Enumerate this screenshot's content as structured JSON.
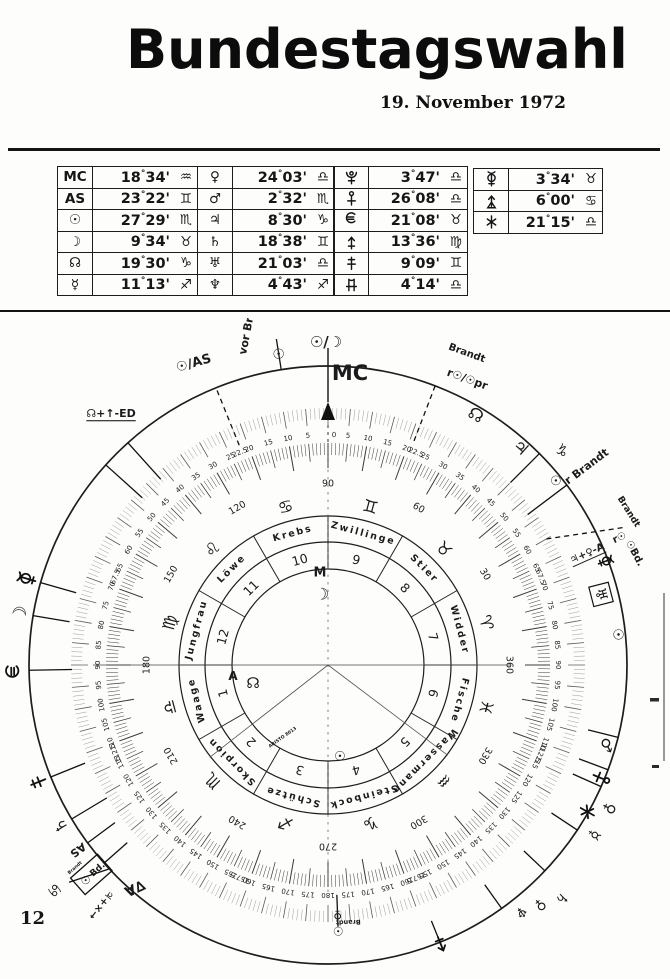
{
  "header": {
    "title": "Bundestagswahl",
    "date": "19. November 1972"
  },
  "page": {
    "number": "12"
  },
  "glyph_unicode": {
    "sun": "☉",
    "moon": "☽",
    "node": "☊",
    "mercury": "☿",
    "venus": "♀",
    "mars": "♂",
    "jupiter": "♃",
    "saturn": "♄",
    "uranus": "♅",
    "neptune": "♆",
    "aries": "♈",
    "taurus": "♉",
    "gemini": "♊",
    "cancer": "♋",
    "leo": "♌",
    "virgo": "♍",
    "libra": "♎",
    "scorpio": "♏",
    "sagittarius": "♐",
    "capricorn": "♑",
    "aquarius": "♒",
    "pisces": "♓"
  },
  "table_groups": [
    6,
    6,
    6,
    3
  ],
  "chart_data": {
    "type": "astrological-dial",
    "title": "Bundestagswahl 19. November 1972",
    "positions": [
      {
        "body": "MC",
        "label": "MC",
        "deg": "18",
        "min": "34",
        "sign": "aquarius"
      },
      {
        "body": "AS",
        "label": "AS",
        "deg": "23",
        "min": "22",
        "sign": "gemini"
      },
      {
        "body": "sun",
        "deg": "27",
        "min": "29",
        "sign": "scorpio"
      },
      {
        "body": "moon",
        "deg": "9",
        "min": "34",
        "sign": "taurus"
      },
      {
        "body": "node",
        "deg": "19",
        "min": "30",
        "sign": "capricorn"
      },
      {
        "body": "mercury",
        "deg": "11",
        "min": "13",
        "sign": "sagittarius"
      },
      {
        "body": "venus",
        "deg": "24",
        "min": "03",
        "sign": "libra"
      },
      {
        "body": "mars",
        "deg": "2",
        "min": "32",
        "sign": "scorpio"
      },
      {
        "body": "jupiter",
        "deg": "8",
        "min": "30",
        "sign": "capricorn"
      },
      {
        "body": "saturn",
        "deg": "18",
        "min": "38",
        "sign": "gemini"
      },
      {
        "body": "uranus",
        "deg": "21",
        "min": "03",
        "sign": "libra"
      },
      {
        "body": "neptune",
        "deg": "4",
        "min": "43",
        "sign": "sagittarius"
      },
      {
        "body": "pluto",
        "deg": "3",
        "min": "47",
        "sign": "libra"
      },
      {
        "body": "cupido",
        "deg": "26",
        "min": "08",
        "sign": "libra"
      },
      {
        "body": "hades",
        "deg": "21",
        "min": "08",
        "sign": "taurus"
      },
      {
        "body": "zeus",
        "deg": "13",
        "min": "36",
        "sign": "virgo"
      },
      {
        "body": "kronos",
        "deg": "9",
        "min": "09",
        "sign": "gemini"
      },
      {
        "body": "apollon",
        "deg": "4",
        "min": "14",
        "sign": "libra"
      },
      {
        "body": "admetos",
        "deg": "3",
        "min": "34",
        "sign": "taurus"
      },
      {
        "body": "vulkanus",
        "deg": "6",
        "min": "00",
        "sign": "cancer"
      },
      {
        "body": "poseidon",
        "deg": "21",
        "min": "15",
        "sign": "libra"
      }
    ],
    "dial": {
      "pointer_label": "MC",
      "top_midpoint": "☉/☽",
      "outer_scale": {
        "label_step": 5,
        "max": 180,
        "specials": [
          22.5,
          67.5,
          112.5,
          157.5
        ]
      },
      "inner_scale": {
        "label_step": 30,
        "max": 360
      },
      "houses": [
        {
          "num": "7",
          "name": "Widder",
          "sign": "aries"
        },
        {
          "num": "8",
          "name": "Stier",
          "sign": "taurus"
        },
        {
          "num": "9",
          "name": "Zwillinge",
          "sign": "gemini"
        },
        {
          "num": "10",
          "name": "Krebs",
          "sign": "cancer"
        },
        {
          "num": "11",
          "name": "Löwe",
          "sign": "leo"
        },
        {
          "num": "12",
          "name": "Jungfrau",
          "sign": "virgo"
        },
        {
          "num": "1",
          "name": "Waage",
          "sign": "libra"
        },
        {
          "num": "2",
          "name": "Skorpion",
          "sign": "scorpio"
        },
        {
          "num": "3",
          "name": "Schütze",
          "sign": "sagittarius"
        },
        {
          "num": "4",
          "name": "Steinbock",
          "sign": "capricorn"
        },
        {
          "num": "5",
          "name": "Wassermann",
          "sign": "aquarius"
        },
        {
          "num": "6",
          "name": "Fische",
          "sign": "pisces"
        }
      ],
      "center_marks": [
        {
          "text": "M",
          "x": -8,
          "y": -92,
          "f": 13
        },
        {
          "glyph": "moon",
          "x": -6,
          "y": -71,
          "f": 16
        },
        {
          "text": "A",
          "x": -95,
          "y": 11,
          "f": 12
        },
        {
          "glyph": "node",
          "x": -75,
          "y": 18,
          "f": 15
        },
        {
          "glyph": "sun",
          "x": 12,
          "y": 92,
          "f": 13
        },
        {
          "text": "ARISTO 8013",
          "x": -45,
          "y": 73,
          "f": 4.5,
          "rot": -35
        }
      ],
      "rim_items": [
        {
          "a": -9,
          "glyph": "sun",
          "r": 314,
          "f": 14,
          "line": [
            299,
            330
          ]
        },
        {
          "a": -13,
          "text": "vor Brandt",
          "r": 352,
          "rot": -79,
          "f": 11,
          "bold": true
        },
        {
          "a": -22,
          "dashed": true,
          "line": [
            237,
            299
          ]
        },
        {
          "a": -24,
          "text": "☉/AS",
          "r": 330,
          "rot": -16,
          "f": 13,
          "bold": true
        },
        {
          "a": -42,
          "line": [
            250,
            299
          ]
        },
        {
          "a": -48,
          "line": [
            250,
            299
          ]
        },
        {
          "a": -40.8,
          "text": "☊+↑-ED",
          "r": 332,
          "rot": 0,
          "f": 11,
          "u": true,
          "bold": true
        },
        {
          "a": -74,
          "glyph": "admetos",
          "r": 313,
          "line": [
            299,
            262
          ]
        },
        {
          "a": -80.5,
          "glyph": "moon",
          "r": 312,
          "f": 18,
          "line": [
            299,
            262
          ]
        },
        {
          "a": -91,
          "glyph": "hades",
          "r": 313,
          "line": [
            299,
            256
          ]
        },
        {
          "a": -112,
          "glyph": "kronos",
          "r": 313,
          "line": [
            299,
            262
          ]
        },
        {
          "a": -121,
          "glyph": "saturn",
          "r": 312,
          "f": 16,
          "line": [
            299,
            258
          ]
        },
        {
          "a": -126.5,
          "text": "AS",
          "r": 311,
          "rot": 143,
          "f": 11,
          "bold": true,
          "line": [
            299,
            265
          ]
        },
        {
          "a": -131.5,
          "boxgroup": true,
          "r": 316,
          "box_text": "Bd.",
          "box_glyph": "sun",
          "box_small": "Brandt",
          "line": [
            299,
            268
          ]
        },
        {
          "a": -129.5,
          "glyph": "cancer",
          "r": 354,
          "f": 15,
          "line2": [
            -133,
            299,
            -130,
            338
          ]
        },
        {
          "a": -136.5,
          "text": "♃+×→",
          "r": 330,
          "rot": 128,
          "f": 10,
          "bold": true
        },
        {
          "a": -139,
          "text": "∇A",
          "r": 295,
          "rot": 155,
          "f": 14,
          "bold": true
        },
        {
          "a": 24,
          "text": "Brandt",
          "r": 341,
          "rot": 20,
          "f": 10,
          "bold": true
        },
        {
          "a": 26,
          "text": "r☉/☉pr",
          "r": 318,
          "rot": 20,
          "f": 11,
          "bold": true
        },
        {
          "a": 21,
          "dashed": true,
          "line": [
            240,
            299
          ]
        },
        {
          "a": 30.6,
          "glyph": "node",
          "r": 290,
          "f": 17
        },
        {
          "a": 41.6,
          "glyph": "jupiter",
          "r": 290,
          "f": 17
        },
        {
          "a": 45,
          "line": [
            258,
            299
          ]
        },
        {
          "a": 47.5,
          "glyph": "capricorn",
          "r": 317,
          "f": 15
        },
        {
          "a": 51,
          "glyph": "sun",
          "r": 292,
          "f": 13
        },
        {
          "a": 52.5,
          "text": "r Brandt",
          "r": 326,
          "rot": -37,
          "f": 11,
          "bold": true
        },
        {
          "a": 53,
          "line": [
            250,
            299
          ]
        },
        {
          "a": 65,
          "dashed": true,
          "line2": [
            65,
            325,
            60,
            252
          ]
        },
        {
          "a": 63,
          "text": "Brandt",
          "r": 337,
          "rot": 58,
          "f": 9,
          "bold": true
        },
        {
          "a": 66.5,
          "text": "r☉",
          "r": 318,
          "rot": -24,
          "f": 10,
          "bold": true
        },
        {
          "a": 70,
          "text": "☉Bd.",
          "r": 326,
          "rot": 62,
          "f": 10,
          "bold": true
        },
        {
          "a": 66.8,
          "text": "♃+♀-A",
          "r": 282,
          "rot": -24,
          "f": 10,
          "u": true,
          "bold": true
        },
        {
          "a": 69.5,
          "glyph": "admetos",
          "r": 296,
          "s": 0.8
        },
        {
          "a": 75.5,
          "glyph": "uranus",
          "r": 282,
          "f": 15,
          "boxed": true
        },
        {
          "a": 84,
          "glyph": "sun",
          "r": 291,
          "f": 14
        },
        {
          "a": 104,
          "line": [
            268,
            299
          ]
        },
        {
          "a": 106,
          "glyph": "mars",
          "r": 290,
          "f": 16
        },
        {
          "a": 110.5,
          "line": [
            268,
            299
          ]
        },
        {
          "a": 112.5,
          "glyph": "cupido",
          "r": 295
        },
        {
          "a": 114,
          "line": [
            268,
            299
          ]
        },
        {
          "a": 117,
          "glyph": "venus",
          "r": 316,
          "f": 15
        },
        {
          "a": 119.5,
          "glyph": "poseidon",
          "r": 298
        },
        {
          "a": 122.5,
          "glyph": "mercury",
          "r": 316,
          "f": 15
        },
        {
          "a": 123.5,
          "line": [
            268,
            299
          ]
        },
        {
          "a": 133.5,
          "line": [
            270,
            299
          ]
        },
        {
          "a": 135,
          "glyph": "saturn",
          "r": 330,
          "f": 14
        },
        {
          "a": 138.5,
          "glyph": "venus",
          "r": 320,
          "f": 14
        },
        {
          "a": 142,
          "glyph": "neptune",
          "r": 313,
          "f": 14
        },
        {
          "a": 144.5,
          "line": [
            270,
            299
          ]
        },
        {
          "a": 158,
          "glyph": "zeus",
          "r": 302,
          "line": [
            276,
            299
          ]
        },
        {
          "a": 177.8,
          "line": [
            230,
            262
          ]
        },
        {
          "a": 177.8,
          "glyph": "venus",
          "r": 250,
          "f": 12
        },
        {
          "a": 177.8,
          "glyph": "sun",
          "r": 266,
          "f": 12
        },
        {
          "a": 175.5,
          "text": "Brandt",
          "r": 258,
          "rot": 178,
          "f": 6.5,
          "bold": true
        }
      ]
    }
  }
}
